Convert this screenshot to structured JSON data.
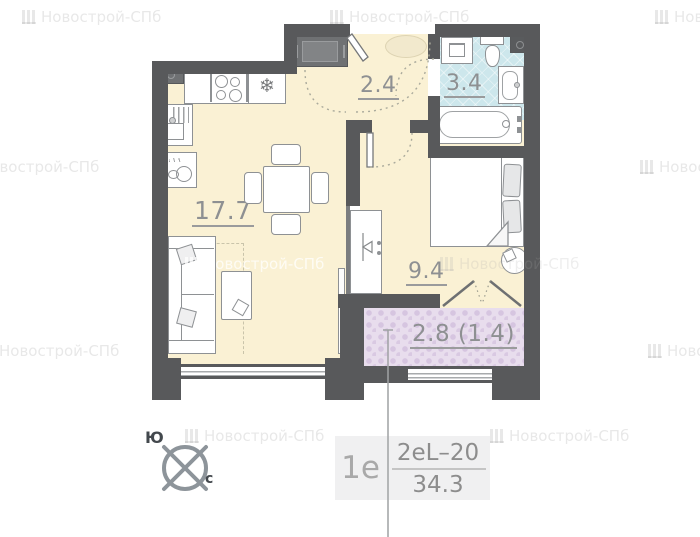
{
  "watermark": {
    "brand": "Новострой-СПб"
  },
  "rooms": {
    "kitchen_living": {
      "area": "17.7"
    },
    "hall": {
      "area": "2.4"
    },
    "bathroom": {
      "area": "3.4"
    },
    "bedroom": {
      "area": "9.4"
    },
    "balcony": {
      "area": "2.8 (1.4)"
    }
  },
  "info_box": {
    "flat_type": "1е",
    "layout_code": "2еL–20",
    "total_area": "34.3"
  },
  "compass": {
    "south_label": "Ю",
    "north_label": "с"
  },
  "icons": {
    "fridge_snowflake": "❄"
  },
  "colors": {
    "wall": "#58595b",
    "floor": "#faf1d4",
    "bathroom_floor": "#cde7ec",
    "balcony_floor": "#e8dded",
    "label": "#8e9092"
  }
}
